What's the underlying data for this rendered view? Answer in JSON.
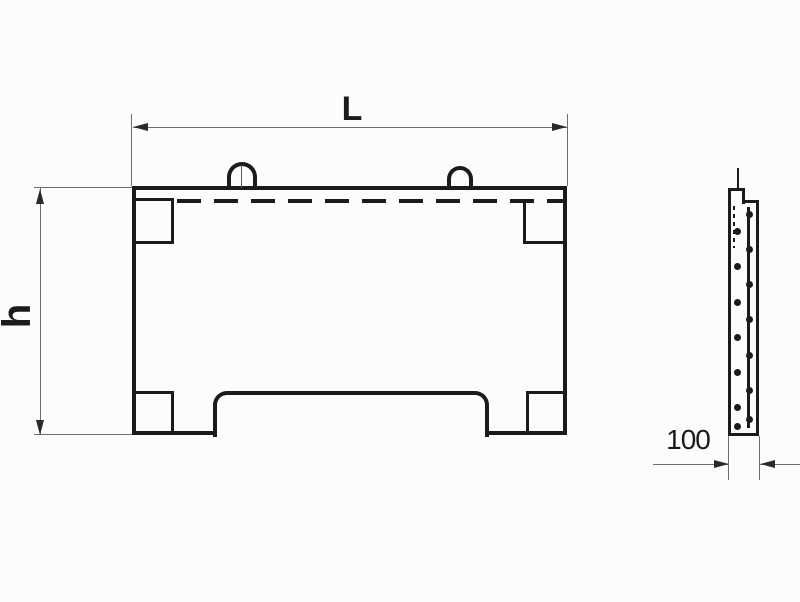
{
  "front_view": {
    "length_label": "L",
    "height_label": "h"
  },
  "side_view": {
    "thickness_label": "100"
  },
  "colors": {
    "line": "#1c1b19",
    "dimension_line": "#6e6e6e",
    "background": "#fdfcfa"
  }
}
